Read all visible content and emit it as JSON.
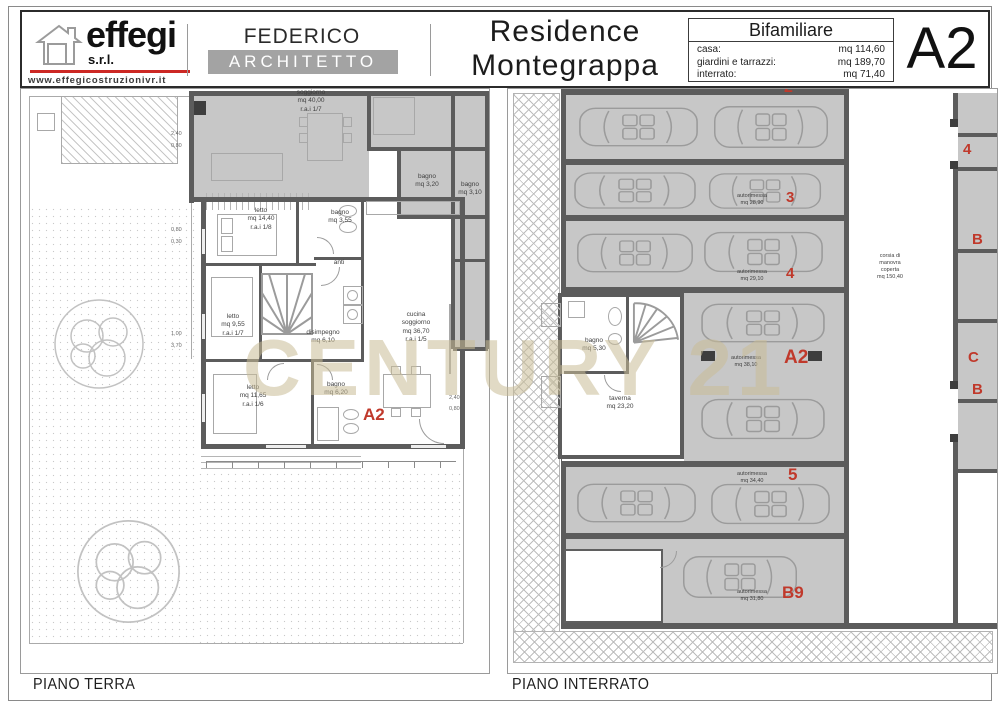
{
  "header": {
    "company": {
      "name": "effegi",
      "suffix": "s.r.l.",
      "website": "www.effegicostruzionivr.it"
    },
    "architect": {
      "name": "FEDERICO GIULIARI",
      "role": "ARCHITETTO"
    },
    "project": {
      "line1": "Residence",
      "line2": "Montegrappa"
    },
    "info": {
      "title": "Bifamiliare",
      "rows": [
        {
          "label": "casa:",
          "value": "mq 114,60"
        },
        {
          "label": "giardini e tarrazzi:",
          "value": "mq 189,70"
        },
        {
          "label": "interrato:",
          "value": "mq 71,40"
        }
      ]
    },
    "unit": "A2"
  },
  "watermark": "CENTURY 21",
  "ground_floor": {
    "title": "PIANO TERRA",
    "unit_label": "A2",
    "rooms": {
      "soggiorno": {
        "name": "soggiorno",
        "area": "mq 40,00",
        "rai": "r.a.i 1/7"
      },
      "bagno_nord": {
        "name": "bagno",
        "area": "mq 3,20"
      },
      "bagno_est": {
        "name": "bagno",
        "area": "mq 3,10"
      },
      "letto1": {
        "name": "letto",
        "area": "mq 14,40",
        "rai": "r.a.i 1/8"
      },
      "bagno1": {
        "name": "bagno",
        "area": "mq 3,55"
      },
      "anti": {
        "name": "anti"
      },
      "letto2": {
        "name": "letto",
        "area": "mq 9,55",
        "rai": "r.a.i 1/7"
      },
      "disimpegno": {
        "name": "disimpegno",
        "area": "mq 6,10"
      },
      "letto3": {
        "name": "letto",
        "area": "mq 11,65",
        "rai": "r.a.i 1/6"
      },
      "bagno2": {
        "name": "bagno",
        "area": "mq 6,20"
      },
      "cucina": {
        "name": "cucina",
        "name2": "soggiorno",
        "area": "mq 36,70",
        "rai": "r.a.i 1/5"
      }
    },
    "dims": {
      "a": "2,40",
      "b": "0,80",
      "c": "0,80",
      "d": "0,30",
      "e": "1,00",
      "f": "3,70",
      "g": "2,40",
      "h": "0,80"
    }
  },
  "basement": {
    "title": "PIANO INTERRATO",
    "rooms": {
      "bagno": {
        "name": "bagno",
        "area": "mq 5,30"
      },
      "taverna": {
        "name": "taverna",
        "area": "mq 23,20"
      }
    },
    "garages": [
      {
        "number": "2"
      },
      {
        "name": "autorimessa",
        "area": "mq 28,90",
        "number": "3"
      },
      {
        "name": "autorimessa",
        "area": "mq 29,10",
        "number": "4"
      },
      {
        "name": "autorimessa",
        "area": "mq 38,10",
        "number": "A2"
      },
      {
        "name": "autorimessa",
        "area": "mq 34,40",
        "number": "5"
      },
      {
        "name": "autorimessa",
        "area": "mq 31,80",
        "number": "B9"
      }
    ],
    "aisle": {
      "l1": "corsia di",
      "l2": "manovra",
      "l3": "coperta",
      "l4": "mq 150,40"
    },
    "edge_labels": [
      "4",
      "B",
      "C",
      "B"
    ]
  },
  "colors": {
    "brand_red": "#cc2824",
    "label_red": "#c0392b",
    "watermark": "#c8bc9c",
    "wall": "#5c5c5c"
  }
}
